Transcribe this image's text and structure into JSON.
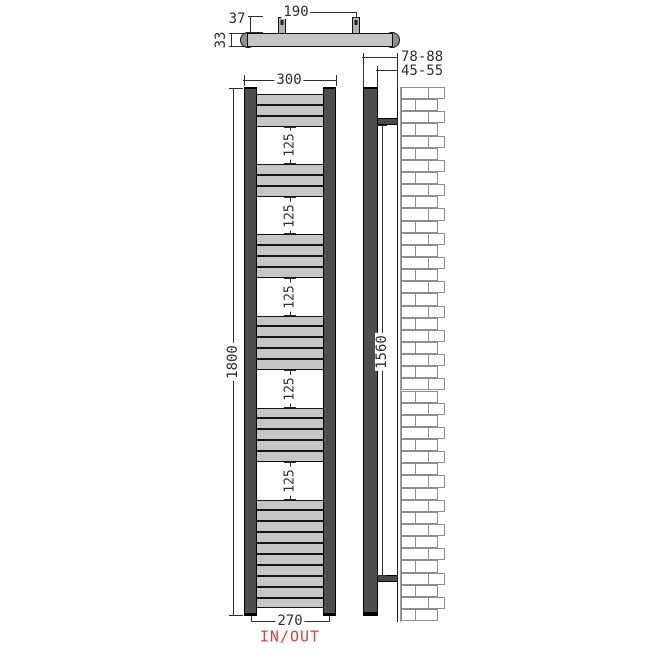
{
  "drawing": {
    "type": "radiator-technical-drawing",
    "views": {
      "top": {
        "dim_bracket_spacing": "190",
        "dim_bracket_depth": "37",
        "dim_tube_diameter": "33"
      },
      "front": {
        "dim_width": "300",
        "dim_height": "1800",
        "dim_connection_spacing": "270",
        "connection_label": "IN/OUT",
        "dim_gap": "125",
        "gap_count": 5,
        "tube_groups": [
          3,
          3,
          4,
          5,
          5,
          10
        ]
      },
      "side": {
        "dim_wall_distance_front": "78-88",
        "dim_wall_distance_back": "45-55",
        "dim_bracket_span": "1560"
      }
    },
    "colors": {
      "rail": "#4e4e4e",
      "tube_bar": "#c6c6c6",
      "outline": "#141414",
      "dimension": "#2e2e2e",
      "inout_red": "#e03e38",
      "brick_line": "#8e8e8e"
    }
  }
}
